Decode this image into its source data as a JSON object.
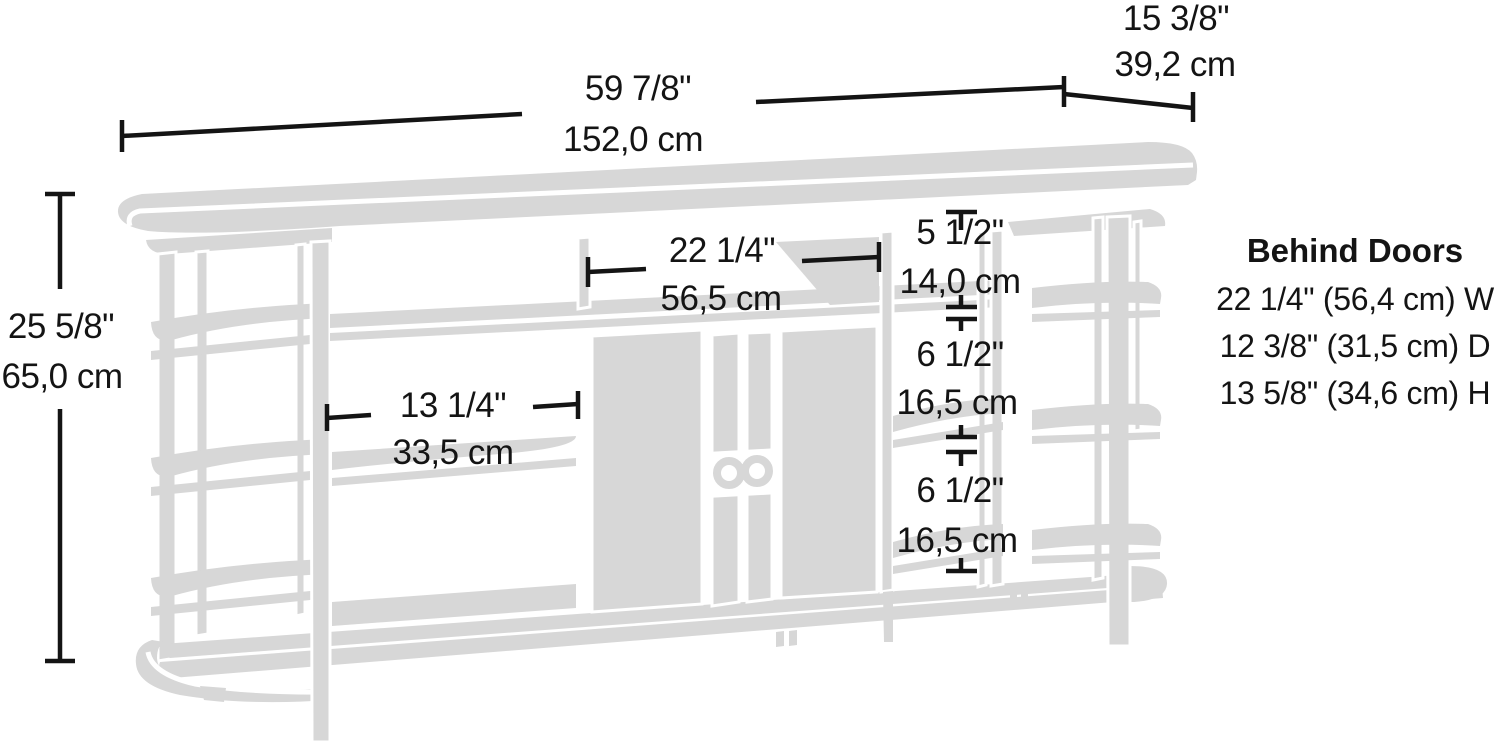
{
  "diagram": {
    "title": "TV credenza dimension drawing",
    "colors": {
      "line_art": "#d7d7d7",
      "annotation": "#141414",
      "background": "#ffffff"
    },
    "dimensions": {
      "overall_width": {
        "inches": "59 7/8\"",
        "cm": "152,0 cm"
      },
      "overall_depth": {
        "inches": "15 3/8\"",
        "cm": "39,2 cm"
      },
      "overall_height": {
        "inches": "25 5/8\"",
        "cm": "65,0 cm"
      },
      "center_opening_width": {
        "inches": "22 1/4\"",
        "cm": "56,5 cm"
      },
      "left_opening_width": {
        "inches": "13 1/4\"",
        "cm": "33,5 cm"
      },
      "right_top_opening_height": {
        "inches": "5 1/2\"",
        "cm": "14,0 cm"
      },
      "right_middle_opening_height": {
        "inches": "6 1/2\"",
        "cm": "16,5 cm"
      },
      "right_bottom_opening_height": {
        "inches": "6 1/2\"",
        "cm": "16,5 cm"
      }
    },
    "behind_doors": {
      "title": "Behind Doors",
      "width_line": "22 1/4\" (56,4 cm) W",
      "depth_line": "12 3/8\" (31,5 cm) D",
      "height_line": "13 5/8\" (34,6 cm) H"
    }
  }
}
